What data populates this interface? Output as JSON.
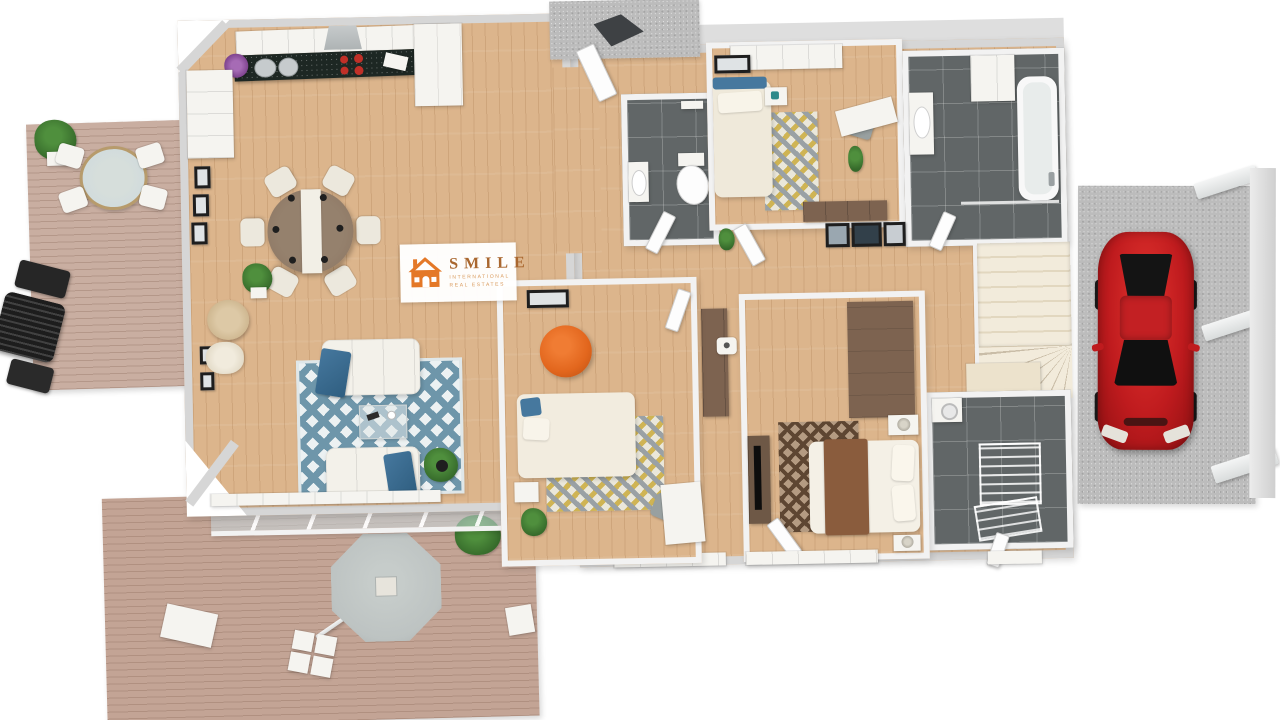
{
  "alt": "3D rendered top-down floor plan of a furnished single-storey house with wrap-around wooden deck, outdoor parasol seating, and a red car parked in the carport",
  "logo": {
    "brand": "SMILE",
    "tagline_line1": "INTERNATIONAL",
    "tagline_line2": "REAL ESTATES",
    "icon": "house-icon"
  },
  "colors": {
    "wall": "#d6d6d6",
    "wall_inner": "#f2f2f2",
    "wood_floor": "#dcb58c",
    "deck_upper": "#c9aea1",
    "deck_lower": "#c3a495",
    "tile_dark": "#616667",
    "concrete": "#bcbcbc",
    "counter_black": "#1d2723",
    "table_wood": "#8b7461",
    "sofa_cream": "#f3f1ea",
    "throw_blue": "#46789e",
    "rug_blue": "#6e96aa",
    "rug_base": "#ecf1f2",
    "rug_gold": "#cfb454",
    "rug_gray": "#9aa1a5",
    "rug_cream": "#eae7da",
    "rug_brown_base": "#b49b82",
    "rug_brown_line": "#5e4632",
    "stairs_a": "#f2ebdb",
    "stairs_b": "#e2d7bf",
    "accent_orange": "#e2661d",
    "logo_orange": "#e47827",
    "logo_text": "#a9672f",
    "logo_sub": "#d99a5c",
    "car_red": "#bf1b1e",
    "car_dark": "#141414",
    "parasol": "#bdc3c2",
    "plant_green": "#4f8f3d",
    "plant_dark": "#35692a",
    "brown_furniture": "#7d6350",
    "porch_mat": "#3e4144",
    "glass": "#cdd9dd"
  }
}
